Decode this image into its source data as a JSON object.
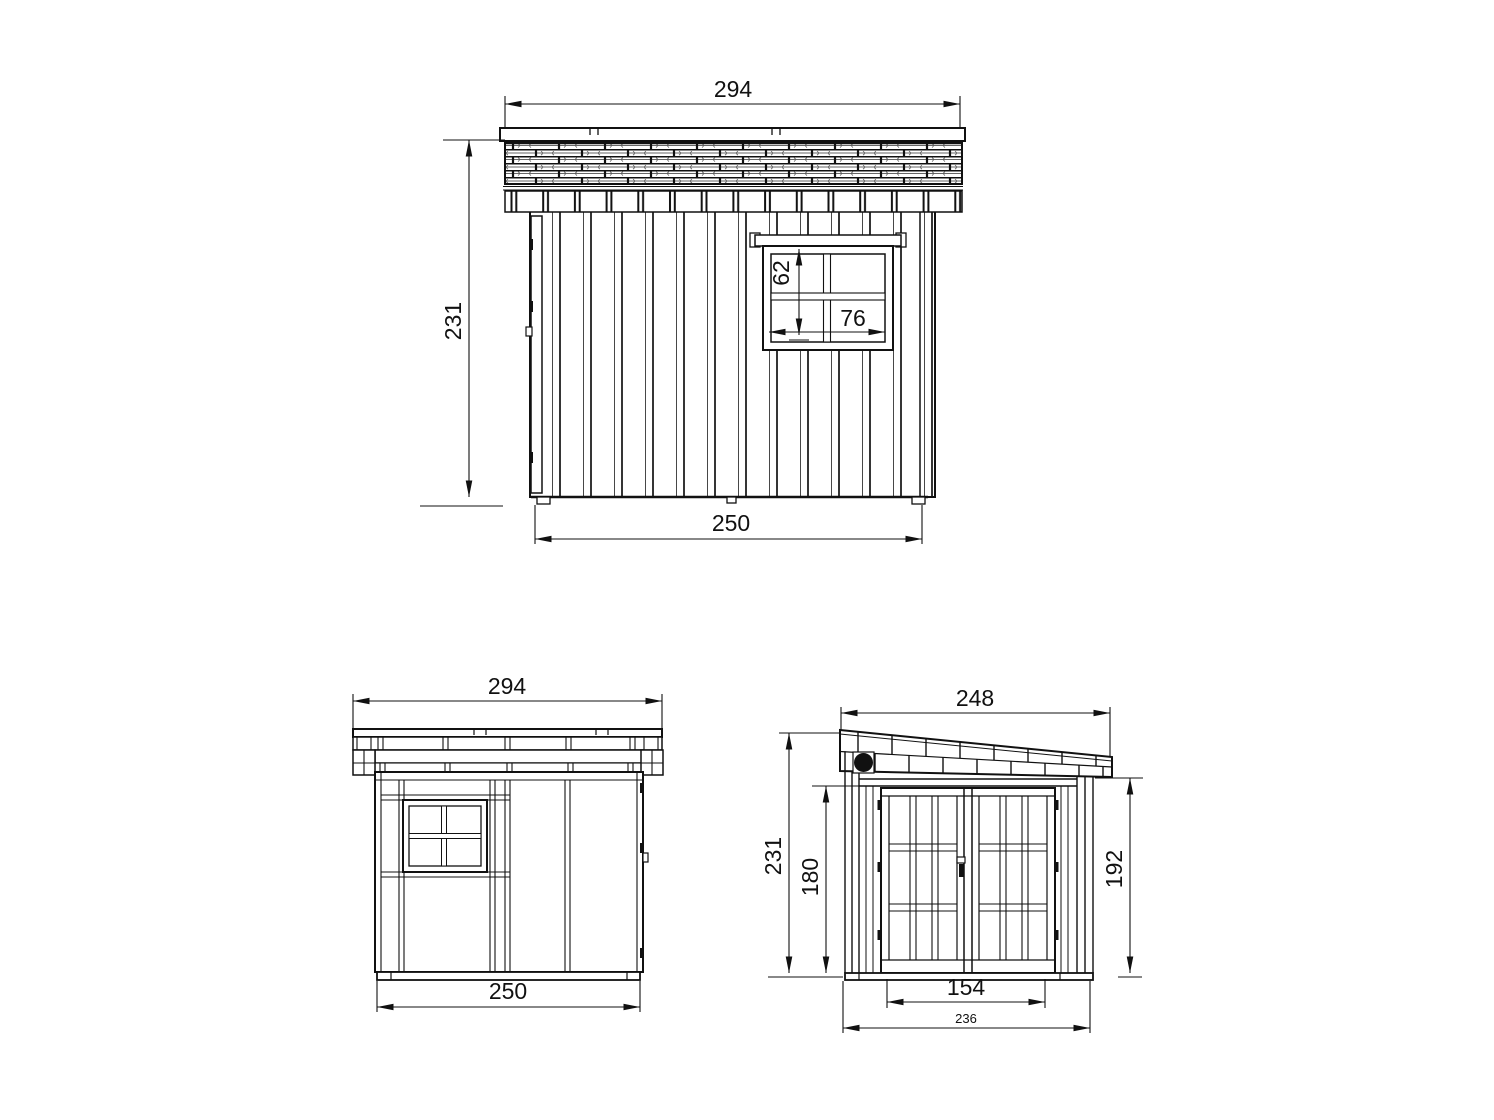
{
  "drawing": {
    "background": "#ffffff",
    "line_color": "#111111",
    "views": {
      "side_a": {
        "roof_width": "294",
        "wall_height": "231",
        "window_height": "62",
        "window_width": "76",
        "wall_width": "250"
      },
      "side_b": {
        "roof_width": "294",
        "wall_width": "250"
      },
      "front": {
        "roof_depth": "248",
        "height_left": "231",
        "door_height": "180",
        "height_right": "192",
        "door_width": "154",
        "base_depth": "236"
      }
    }
  }
}
